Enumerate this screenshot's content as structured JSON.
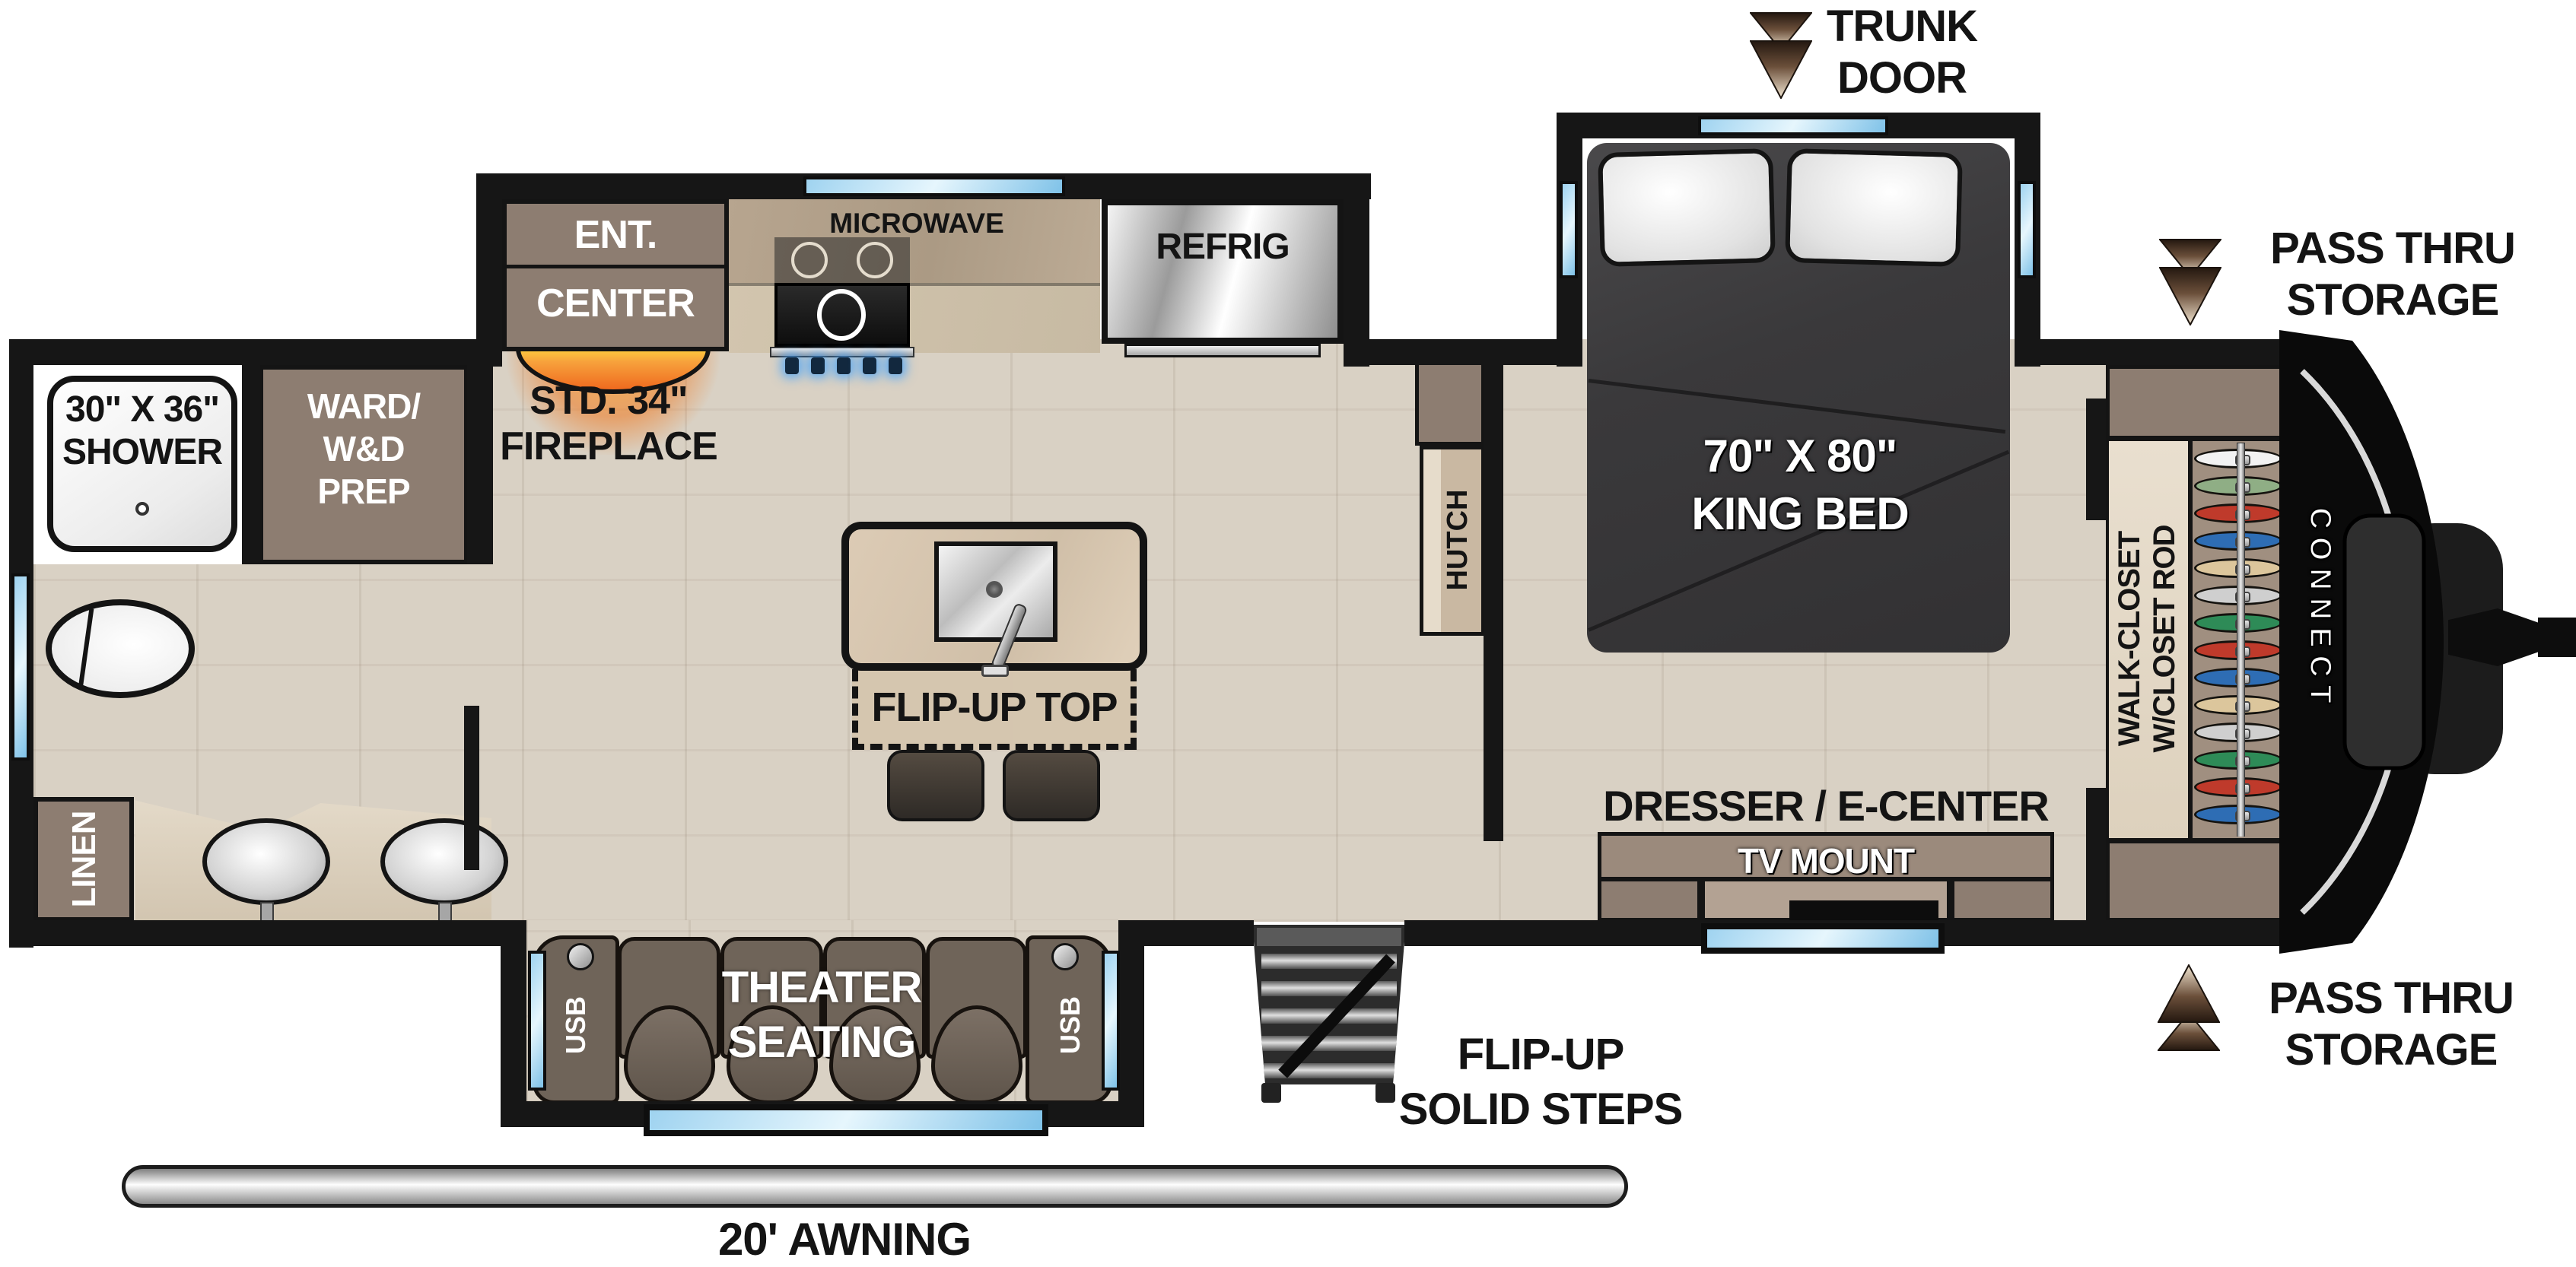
{
  "title": "Travel trailer floor plan - Connect",
  "colors": {
    "wall": "#161616",
    "floor_wood": "#d9d1c4",
    "cabinet": "#8d7d71",
    "counter_dark": "#b4a28c",
    "counter_light": "#cfc2ab",
    "island_marble": "#d9c9b3",
    "window_glass": "#9fd3f0",
    "bed": "#3a393b",
    "theater_seat": "#6f6459",
    "fireplace_orange": "#ef6a1f",
    "silver": "#c8c8c8",
    "arrow_brown": "#5a4129"
  },
  "labels": {
    "trunk": {
      "line1": "TRUNK",
      "line2": "DOOR"
    },
    "pass_top": {
      "line1": "PASS THRU",
      "line2": "STORAGE"
    },
    "pass_bottom": {
      "line1": "PASS THRU",
      "line2": "STORAGE"
    }
  },
  "bedroom": {
    "bed": {
      "line1": "70\" X 80\"",
      "line2": "KING BED"
    },
    "closet": {
      "line1": "WALK-CLOSET",
      "line2": "W/CLOSET ROD",
      "hanger_colors": [
        "#f2f2f2",
        "#8fae85",
        "#bf3a2b",
        "#2e6db4",
        "#dcc69c",
        "#cfcfcf",
        "#2e8b57",
        "#bf3a2b",
        "#2e6db4",
        "#dcc69c",
        "#cfcfcf",
        "#2e8b57",
        "#bf3a2b",
        "#2e6db4"
      ]
    },
    "dresser_label": "DRESSER / E-CENTER",
    "tv_label": "TV MOUNT",
    "hutch_label": "HUTCH"
  },
  "kitchen": {
    "ent": {
      "line1": "ENT.",
      "line2": "CENTER"
    },
    "fireplace": {
      "line1": "STD. 34\"",
      "line2": "FIREPLACE"
    },
    "microwave_label": "MICROWAVE",
    "refrig_label": "REFRIG",
    "island_label": "FLIP-UP TOP"
  },
  "bath": {
    "shower": {
      "line1": "30\" X 36\"",
      "line2": "SHOWER"
    },
    "ward": {
      "line1": "WARD/",
      "line2": "W&D",
      "line3": "PREP"
    },
    "linen_label": "LINEN"
  },
  "living": {
    "theater": {
      "line1": "THEATER",
      "line2": "SEATING"
    },
    "usb_label": "USB"
  },
  "exterior": {
    "steps": {
      "line1": "FLIP-UP",
      "line2": "SOLID STEPS"
    },
    "awning_label": "20' AWNING",
    "brand": "CONNECT"
  }
}
